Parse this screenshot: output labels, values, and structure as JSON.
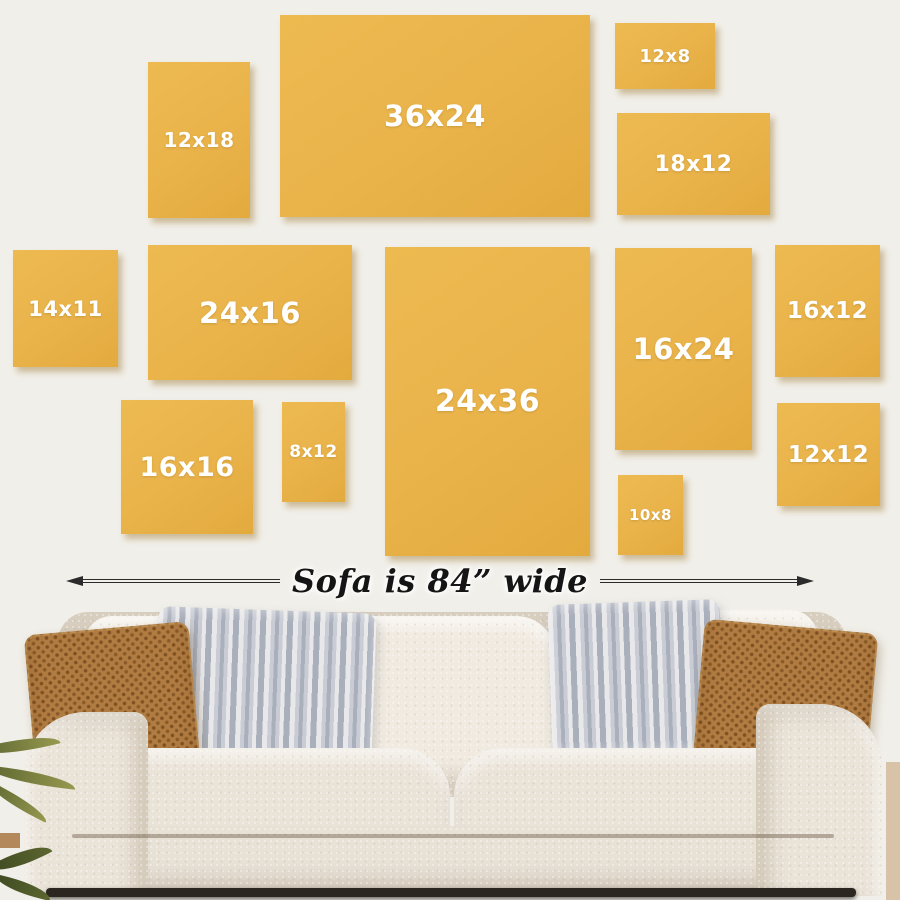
{
  "colors": {
    "wall": "#F1EFE9",
    "frame": "#E9B34A",
    "frameShadow": "rgba(150,112,38,0.42)",
    "frameLabel": "#FFFFFF",
    "ink": "#2B2B2B",
    "sofa": "#EAE3D8",
    "sofaLight": "#F0EAE0",
    "sofaShade": "#D8CEC0",
    "skirt": "#E8E1D6",
    "brownPillow": "#B17C42",
    "brownPillowDot": "#7E5122",
    "grayLight": "#E8E8EA",
    "grayMid": "#C9CCD4",
    "grayDark": "#A9AFBB",
    "plantDark": "#5C6630",
    "plantLight": "#97994F",
    "wood": "#B3895C",
    "floorShadow": "#2C2620",
    "sideStrip": "#D8C3A9"
  },
  "frames": [
    {
      "label": "12x18",
      "x": 148,
      "y": 62,
      "w": 102,
      "h": 156,
      "fs": 20
    },
    {
      "label": "36x24",
      "x": 280,
      "y": 15,
      "w": 310,
      "h": 202,
      "fs": 29
    },
    {
      "label": "12x8",
      "x": 615,
      "y": 23,
      "w": 100,
      "h": 66,
      "fs": 18
    },
    {
      "label": "18x12",
      "x": 617,
      "y": 113,
      "w": 153,
      "h": 102,
      "fs": 22
    },
    {
      "label": "14x11",
      "x": 13,
      "y": 250,
      "w": 105,
      "h": 117,
      "fs": 21
    },
    {
      "label": "24x16",
      "x": 148,
      "y": 245,
      "w": 204,
      "h": 135,
      "fs": 29
    },
    {
      "label": "24x36",
      "x": 385,
      "y": 247,
      "w": 205,
      "h": 309,
      "fs": 30
    },
    {
      "label": "16x24",
      "x": 615,
      "y": 248,
      "w": 137,
      "h": 202,
      "fs": 29
    },
    {
      "label": "16x12",
      "x": 775,
      "y": 245,
      "w": 105,
      "h": 132,
      "fs": 23
    },
    {
      "label": "16x16",
      "x": 121,
      "y": 400,
      "w": 132,
      "h": 134,
      "fs": 27
    },
    {
      "label": "8x12",
      "x": 282,
      "y": 402,
      "w": 63,
      "h": 100,
      "fs": 17
    },
    {
      "label": "12x12",
      "x": 777,
      "y": 403,
      "w": 103,
      "h": 103,
      "fs": 23
    },
    {
      "label": "10x8",
      "x": 618,
      "y": 475,
      "w": 65,
      "h": 80,
      "fs": 15
    }
  ],
  "dimension": {
    "text": "Sofa is 84” wide",
    "left_icon": "left-arrowhead-icon",
    "right_icon": "right-arrowhead-icon"
  }
}
